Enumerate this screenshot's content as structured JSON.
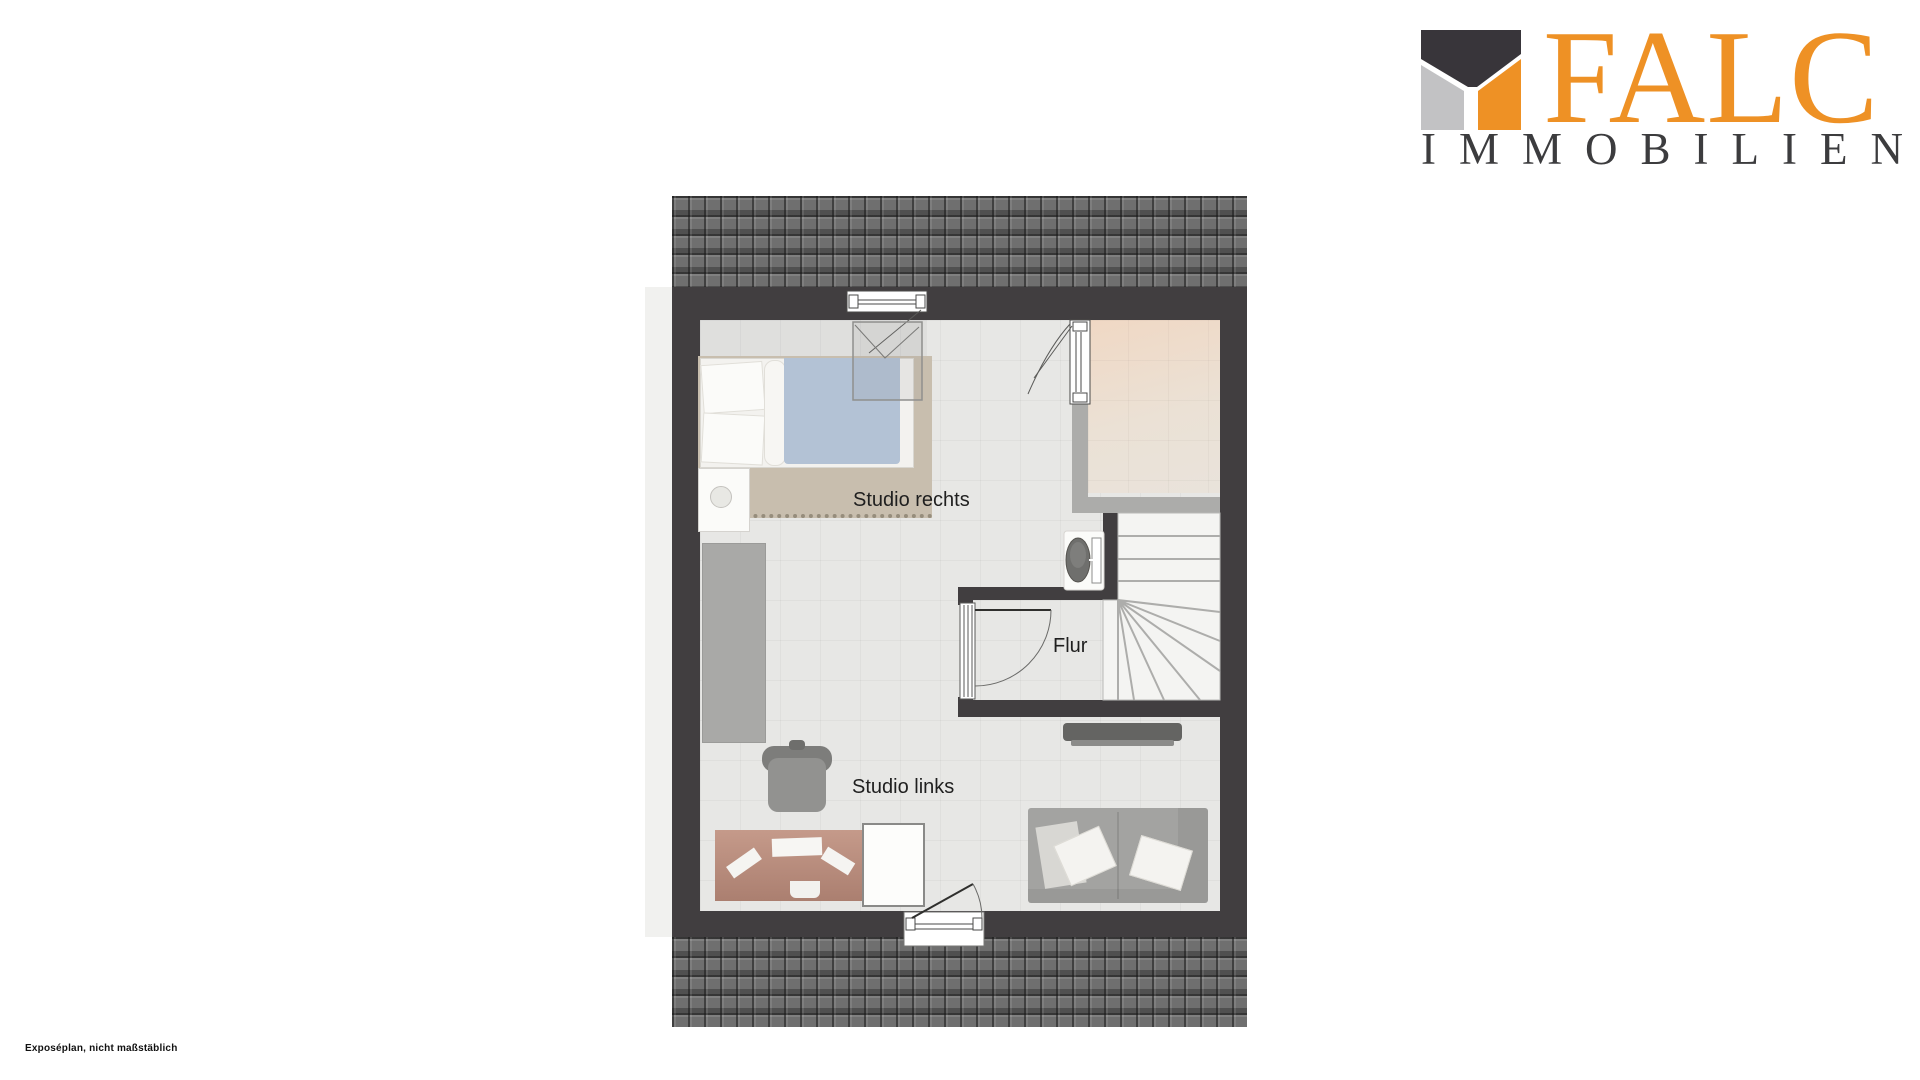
{
  "logo": {
    "brand": "FALC",
    "subtitle": "IMMOBILIEN",
    "brand_color": "#ee9125",
    "subtitle_color": "#3c3c3e",
    "mark_colors": {
      "top": "#38353a",
      "left": "#c2c2c4",
      "right": "#ee9125"
    }
  },
  "plan": {
    "rooms": {
      "studio_rechts": {
        "label": "Studio rechts"
      },
      "flur": {
        "label": "Flur"
      },
      "studio_links": {
        "label": "Studio links"
      }
    },
    "features": [
      "roof-tiles-top",
      "roof-tiles-bottom",
      "winder-staircase",
      "toilet",
      "top-window",
      "skylight",
      "side-window",
      "flur-door",
      "entry-door"
    ],
    "furniture": [
      "double-bed",
      "nightstand",
      "rug",
      "wardrobe",
      "office-chair",
      "desk",
      "cabinet",
      "tv-sideboard",
      "sofa"
    ],
    "colors": {
      "wall": "#413e40",
      "floor": "#e7e7e5",
      "room_accent": "#f0d8c4",
      "rug": "#c8beae",
      "blanket": "#b3c2d5",
      "roof": "#6f6f6f"
    }
  },
  "footer": {
    "disclaimer": "Exposéplan, nicht maßstäblich"
  }
}
